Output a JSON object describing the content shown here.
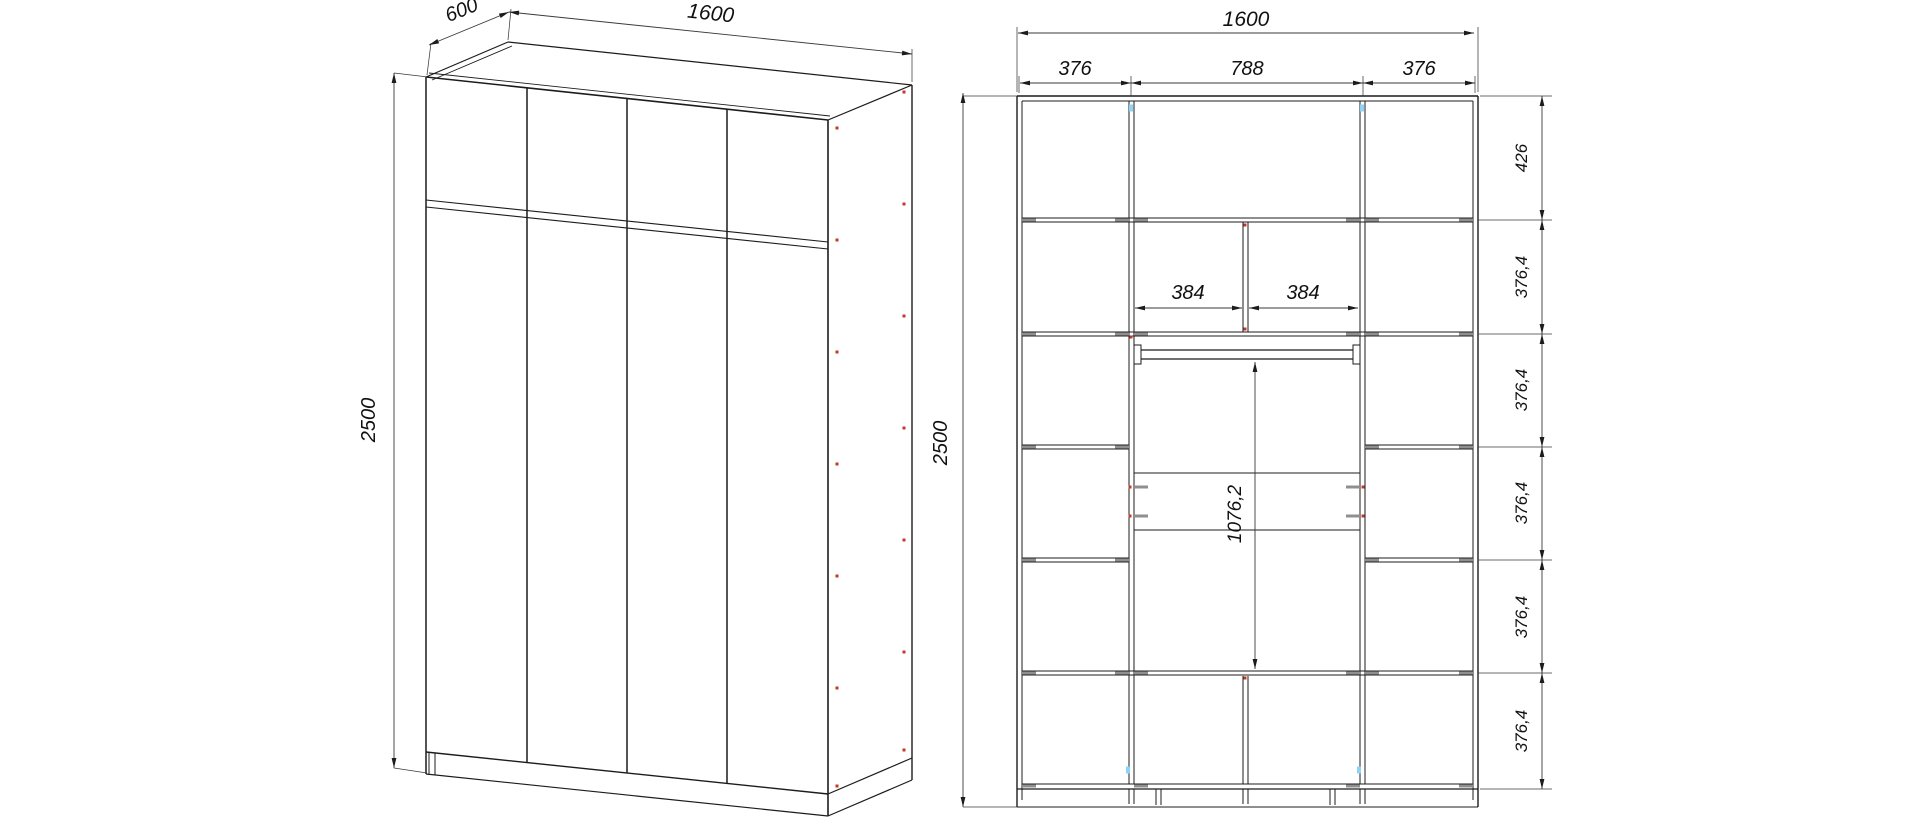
{
  "document": {
    "kind": "furniture-assembly-drawing",
    "background": "#ffffff",
    "views": {
      "left": {
        "label": "wardrobe-3d-perspective-view"
      },
      "right": {
        "label": "wardrobe-front-elevation-view"
      }
    }
  },
  "dimensions": {
    "overall_width": "1600",
    "overall_depth": "600",
    "overall_height": "2500",
    "columns": [
      "376",
      "788",
      "376"
    ],
    "top_row_height": "426",
    "row_height": "376,4",
    "middle_cells": [
      "384",
      "384"
    ],
    "hanging_space_height": "1076,2"
  },
  "drawing": {
    "colors": {
      "stroke": "#1c1c1c",
      "thin": "#3a3a3a",
      "gray": "#8f8f8f",
      "red": "#c0392b",
      "blue": "#8fd3f4"
    },
    "lines": [
      [
        426,
        77,
        828,
        120,
        1.6
      ],
      [
        429,
        73,
        830,
        116,
        0.9
      ],
      [
        426,
        77,
        508,
        42,
        1.2
      ],
      [
        432,
        80,
        512,
        46,
        0.9
      ],
      [
        508,
        42,
        912,
        85,
        1.2
      ],
      [
        828,
        120,
        912,
        85,
        1.2
      ],
      [
        426,
        77,
        426,
        774,
        1.5
      ],
      [
        828,
        120,
        828,
        816,
        1.6
      ],
      [
        426,
        752,
        828,
        794,
        1.4
      ],
      [
        527,
        88,
        527,
        763,
        1.5
      ],
      [
        627,
        98,
        627,
        773,
        1.5
      ],
      [
        727,
        109,
        727,
        784,
        1.5
      ],
      [
        426,
        200,
        828,
        242,
        1.1
      ],
      [
        426,
        207,
        828,
        249,
        1.1
      ],
      [
        426,
        774,
        828,
        816,
        1.2
      ],
      [
        429,
        753,
        429,
        775,
        1.0
      ],
      [
        435,
        753,
        435,
        775,
        1.0
      ],
      [
        912,
        85,
        912,
        780,
        1.4
      ],
      [
        828,
        794,
        912,
        758,
        1.2
      ],
      [
        828,
        816,
        912,
        780,
        1.2
      ],
      [
        1017,
        96,
        1017,
        807,
        1.4
      ],
      [
        1022,
        101,
        1022,
        800,
        1.0
      ],
      [
        1478,
        96,
        1478,
        807,
        1.4
      ],
      [
        1473,
        101,
        1473,
        800,
        1.0
      ],
      [
        1017,
        96,
        1478,
        96,
        1.4
      ],
      [
        1022,
        101,
        1473,
        101,
        1.0
      ],
      [
        1022,
        784,
        1473,
        784,
        1.0
      ],
      [
        1017,
        789,
        1478,
        789,
        1.2
      ],
      [
        1017,
        807,
        1478,
        807,
        1.1
      ],
      [
        1129,
        101,
        1129,
        784,
        1.0
      ],
      [
        1134,
        101,
        1134,
        784,
        1.0
      ],
      [
        1360,
        101,
        1360,
        784,
        1.0
      ],
      [
        1365,
        101,
        1365,
        784,
        1.0
      ],
      [
        1243,
        222,
        1243,
        332,
        1.0
      ],
      [
        1248,
        222,
        1248,
        332,
        1.0
      ],
      [
        1243,
        676,
        1243,
        784,
        1.0
      ],
      [
        1248,
        676,
        1248,
        784,
        1.0
      ],
      [
        1022,
        218,
        1473,
        218,
        1.0
      ],
      [
        1022,
        222,
        1473,
        222,
        1.0
      ],
      [
        1022,
        332,
        1473,
        332,
        1.0
      ],
      [
        1022,
        336,
        1473,
        336,
        1.0
      ],
      [
        1022,
        445,
        1129,
        445,
        1.0
      ],
      [
        1022,
        449,
        1129,
        449,
        1.0
      ],
      [
        1365,
        445,
        1473,
        445,
        1.0
      ],
      [
        1365,
        449,
        1473,
        449,
        1.0
      ],
      [
        1022,
        558,
        1129,
        558,
        1.0
      ],
      [
        1022,
        562,
        1129,
        562,
        1.0
      ],
      [
        1365,
        558,
        1473,
        558,
        1.0
      ],
      [
        1365,
        562,
        1473,
        562,
        1.0
      ],
      [
        1022,
        671,
        1473,
        671,
        1.0
      ],
      [
        1022,
        675,
        1473,
        675,
        1.0
      ],
      [
        1134,
        473,
        1360,
        473,
        1.0
      ],
      [
        1134,
        530,
        1360,
        530,
        1.0
      ],
      [
        1140,
        350,
        1354,
        350,
        1.2
      ],
      [
        1140,
        359,
        1354,
        359,
        1.2
      ],
      [
        1156,
        789,
        1156,
        805,
        1.0
      ],
      [
        1161,
        789,
        1161,
        805,
        1.0
      ],
      [
        1330,
        789,
        1330,
        805,
        1.0
      ],
      [
        1335,
        789,
        1335,
        805,
        1.0
      ],
      [
        1129,
        789,
        1129,
        804,
        1.0
      ],
      [
        1134,
        789,
        1134,
        804,
        1.0
      ],
      [
        1243,
        789,
        1243,
        804,
        1.0
      ],
      [
        1248,
        789,
        1248,
        804,
        1.0
      ],
      [
        1360,
        789,
        1360,
        804,
        1.0
      ],
      [
        1365,
        789,
        1365,
        804,
        1.0
      ]
    ],
    "rects": [
      {
        "x": 1134,
        "y": 345,
        "w": 7,
        "h": 19
      },
      {
        "x": 1353,
        "y": 345,
        "w": 7,
        "h": 19
      }
    ],
    "exts": [
      [
        394,
        73,
        428,
        77
      ],
      [
        394,
        768,
        427,
        773
      ],
      [
        427,
        75,
        431,
        43
      ],
      [
        508,
        40,
        511,
        9
      ],
      [
        912,
        82,
        912,
        49
      ],
      [
        963,
        96,
        1017,
        96
      ],
      [
        963,
        807,
        1017,
        807
      ],
      [
        1017,
        92,
        1017,
        27
      ],
      [
        1478,
        92,
        1478,
        27
      ],
      [
        1019,
        93,
        1019,
        76
      ],
      [
        1131,
        96,
        1131,
        76
      ],
      [
        1363,
        96,
        1363,
        76
      ],
      [
        1475,
        93,
        1475,
        76
      ],
      [
        1480,
        96,
        1552,
        96
      ],
      [
        1478,
        220,
        1552,
        220
      ],
      [
        1478,
        334,
        1552,
        334
      ],
      [
        1478,
        447,
        1552,
        447
      ],
      [
        1478,
        560,
        1552,
        560
      ],
      [
        1478,
        673,
        1552,
        673
      ],
      [
        1480,
        789,
        1552,
        789
      ]
    ],
    "dims": [
      [
        394,
        73,
        394,
        768
      ],
      [
        429,
        45,
        509,
        12
      ],
      [
        509,
        12,
        912,
        54
      ],
      [
        963,
        93,
        963,
        807
      ],
      [
        1018,
        33,
        1474,
        33
      ],
      [
        1020,
        83,
        1131,
        83
      ],
      [
        1131,
        83,
        1363,
        83
      ],
      [
        1363,
        83,
        1475,
        83
      ],
      [
        1135,
        308,
        1242,
        308
      ],
      [
        1249,
        308,
        1358,
        308
      ],
      [
        1255,
        362,
        1255,
        669
      ],
      [
        1542,
        96,
        1542,
        220
      ],
      [
        1542,
        220,
        1542,
        334
      ],
      [
        1542,
        334,
        1542,
        447
      ],
      [
        1542,
        447,
        1542,
        560
      ],
      [
        1542,
        560,
        1542,
        673
      ],
      [
        1542,
        673,
        1542,
        789
      ]
    ],
    "texts": [
      {
        "name": "height-3d",
        "s": "2500",
        "x": 375,
        "y": 420,
        "r": -90,
        "f": 20
      },
      {
        "name": "depth-3d",
        "s": "600",
        "x": 464,
        "y": 16,
        "r": -22,
        "f": 20
      },
      {
        "name": "width-3d",
        "s": "1600",
        "x": 710,
        "y": 20,
        "r": 6,
        "f": 21
      },
      {
        "name": "width-elev",
        "s": "1600",
        "x": 1246,
        "y": 26,
        "r": 0,
        "f": 21
      },
      {
        "name": "col-left",
        "s": "376",
        "x": 1075,
        "y": 75,
        "r": 0,
        "f": 20
      },
      {
        "name": "col-mid",
        "s": "788",
        "x": 1247,
        "y": 75,
        "r": 0,
        "f": 20
      },
      {
        "name": "col-right",
        "s": "376",
        "x": 1419,
        "y": 75,
        "r": 0,
        "f": 20
      },
      {
        "name": "cell-left",
        "s": "384",
        "x": 1188,
        "y": 299,
        "r": 0,
        "f": 20
      },
      {
        "name": "cell-right",
        "s": "384",
        "x": 1303,
        "y": 299,
        "r": 0,
        "f": 20
      },
      {
        "name": "height-elev",
        "s": "2500",
        "x": 947,
        "y": 443,
        "r": -90,
        "f": 20
      },
      {
        "name": "hanging-height",
        "s": "1076,2",
        "x": 1241,
        "y": 514,
        "r": -90,
        "f": 19
      },
      {
        "name": "row-top",
        "s": "426",
        "x": 1527,
        "y": 158,
        "r": -90,
        "f": 17
      },
      {
        "name": "row-2",
        "s": "376,4",
        "x": 1527,
        "y": 277,
        "r": -90,
        "f": 17
      },
      {
        "name": "row-3",
        "s": "376,4",
        "x": 1527,
        "y": 390,
        "r": -90,
        "f": 17
      },
      {
        "name": "row-4",
        "s": "376,4",
        "x": 1527,
        "y": 503,
        "r": -90,
        "f": 17
      },
      {
        "name": "row-5",
        "s": "376,4",
        "x": 1527,
        "y": 617,
        "r": -90,
        "f": 17
      },
      {
        "name": "row-6",
        "s": "376,4",
        "x": 1527,
        "y": 731,
        "r": -90,
        "f": 17
      }
    ],
    "gray_bars": [
      [
        1029,
        220
      ],
      [
        1122,
        220
      ],
      [
        1141,
        220
      ],
      [
        1353,
        220
      ],
      [
        1372,
        220
      ],
      [
        1466,
        220
      ],
      [
        1029,
        334
      ],
      [
        1122,
        334
      ],
      [
        1141,
        334
      ],
      [
        1353,
        334
      ],
      [
        1372,
        334
      ],
      [
        1466,
        334
      ],
      [
        1029,
        447
      ],
      [
        1122,
        447
      ],
      [
        1372,
        447
      ],
      [
        1466,
        447
      ],
      [
        1029,
        560
      ],
      [
        1122,
        560
      ],
      [
        1372,
        560
      ],
      [
        1466,
        560
      ],
      [
        1029,
        673
      ],
      [
        1122,
        673
      ],
      [
        1141,
        673
      ],
      [
        1353,
        673
      ],
      [
        1372,
        673
      ],
      [
        1466,
        673
      ],
      [
        1141,
        487
      ],
      [
        1141,
        516
      ],
      [
        1353,
        487
      ],
      [
        1353,
        516
      ],
      [
        1029,
        786
      ],
      [
        1141,
        786
      ],
      [
        1353,
        786
      ],
      [
        1466,
        786
      ]
    ],
    "red_dots": [
      [
        837,
        128
      ],
      [
        837,
        240
      ],
      [
        837,
        352
      ],
      [
        837,
        464
      ],
      [
        837,
        576
      ],
      [
        837,
        688
      ],
      [
        837,
        786
      ],
      [
        904,
        92
      ],
      [
        904,
        204
      ],
      [
        904,
        316
      ],
      [
        904,
        428
      ],
      [
        904,
        540
      ],
      [
        904,
        652
      ],
      [
        904,
        750
      ],
      [
        1130,
        487
      ],
      [
        1130,
        516
      ],
      [
        1363,
        487
      ],
      [
        1363,
        516
      ],
      [
        1245,
        225
      ],
      [
        1245,
        329
      ],
      [
        1245,
        678
      ],
      [
        1131,
        337
      ]
    ],
    "blue_dots": [
      [
        1131,
        108
      ],
      [
        1362,
        108
      ],
      [
        1128,
        770
      ],
      [
        1359,
        770
      ]
    ]
  }
}
